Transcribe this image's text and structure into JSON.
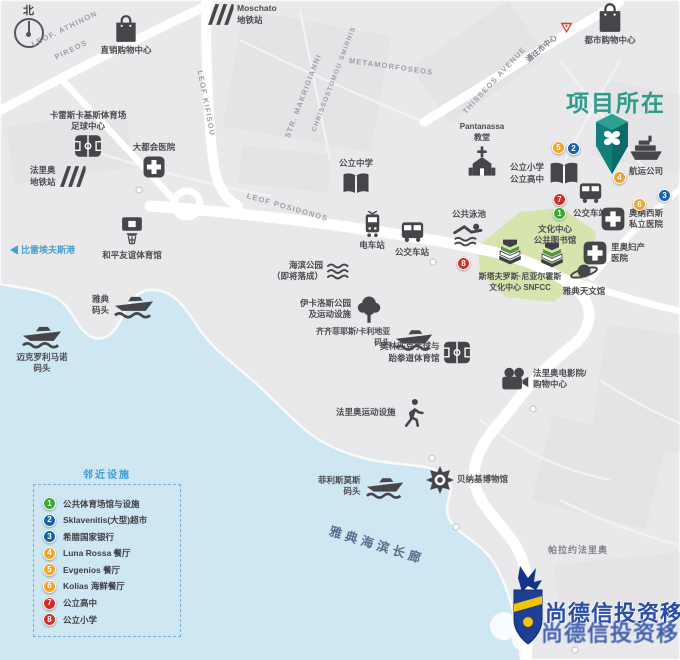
{
  "compass": {
    "north": "北"
  },
  "project": {
    "title": "项目所在"
  },
  "streets": {
    "athinon1": "LEOF. ATHINON",
    "athinon2": "PIREOS",
    "kifisou": "LEOF KIFISOU",
    "makrigianni": "STR. MAKRIGIANNI",
    "chrissostomou": "CHRISSOSTOMOU SMIRNIS",
    "metamorfoseos": "METAMORFOSEOS",
    "thisseos": "THISSEOS AVENUE",
    "posidonos": "LEOF POSIDONOS",
    "to_center": "通往市中心"
  },
  "pois": {
    "outlet_mall": {
      "l1": "直销购物中心"
    },
    "moschato": {
      "l1": "Moschato",
      "l2": "地铁站"
    },
    "faliro_metro": {
      "l1": "法里奥",
      "l2": "地铁站"
    },
    "karaiskakis": {
      "l1": "卡雷斯卡基斯体育场",
      "l2": "足球中心"
    },
    "metropolitan_hospital": {
      "l1": "大都会医院"
    },
    "middle_school": {
      "l1": "公立中学"
    },
    "tram_station": {
      "l1": "电车站"
    },
    "bus_station_center": {
      "l1": "公交车站"
    },
    "public_pool": {
      "l1": "公共泳池"
    },
    "seaside_park": {
      "l1": "海滨公园",
      "l2": "（即将落成）"
    },
    "ikaros_park": {
      "l1": "伊卡洛斯公园",
      "l2": "及运动设施"
    },
    "kallithea_marina": {
      "l1": "齐齐菲耶斯/卡利地亚",
      "l2": "码头"
    },
    "handball_arena": {
      "l1": "奥林匹克手球与",
      "l2": "跆拳道体育馆"
    },
    "faliro_cinema": {
      "l1": "法里奥电影院/",
      "l2": "购物中心"
    },
    "faliro_sports": {
      "l1": "法里奥运动设施"
    },
    "flisvos_marina": {
      "l1": "菲利斯莫斯",
      "l2": "码头"
    },
    "benaki_museum": {
      "l1": "贝纳基博物馆"
    },
    "palaio_faliro": {
      "l1": "帕拉约法里奥"
    },
    "promenade": {
      "l1": "雅典海滨长廊"
    },
    "peace_stadium": {
      "l1": "和平友谊体育馆"
    },
    "piraeus_port": {
      "l1": "比雷埃夫斯港"
    },
    "athens_marina": {
      "l1": "雅典",
      "l2": "码头"
    },
    "mikrolimano": {
      "l1": "迈克罗利马诺",
      "l2": "码头"
    },
    "pantanassa": {
      "l1": "Pantanassa",
      "l2": "教堂"
    },
    "primary_high_school": {
      "l1": "公立小学",
      "l2": "公立高中"
    },
    "bus_station_right": {
      "l1": "公交车站"
    },
    "culture_center": {
      "l1": "文化中心",
      "l2": "公共图书馆"
    },
    "snfcc": {
      "l1": "斯塔夫罗斯·尼亚尔霍斯",
      "l2": "文化中心 SNFCC"
    },
    "onassis_hospital": {
      "l1": "奥纳西斯",
      "l2": "私立医院"
    },
    "maternity_hospital": {
      "l1": "里奥妇产",
      "l2": "医院"
    },
    "planetarium": {
      "l1": "雅典天文馆"
    },
    "shipping_company": {
      "l1": "航运公司"
    },
    "city_mall": {
      "l1": "都市购物中心"
    }
  },
  "badges": {
    "n1": "1",
    "n2": "2",
    "n3": "3",
    "n4": "4",
    "n5": "5",
    "n6": "6",
    "n7": "7",
    "n8": "8"
  },
  "legend": {
    "title": "邻近设施",
    "items": [
      {
        "num": "1",
        "color": "#3aa838",
        "label": "公共体育场馆与设施"
      },
      {
        "num": "2",
        "color": "#1663ad",
        "label": "Sklavenitis(大型)超市"
      },
      {
        "num": "3",
        "color": "#1663ad",
        "label": "希腊国家银行"
      },
      {
        "num": "4",
        "color": "#f5a226",
        "label": "Luna Rossa 餐厅"
      },
      {
        "num": "5",
        "color": "#f5a226",
        "label": "Evgenios 餐厅"
      },
      {
        "num": "6",
        "color": "#f5a226",
        "label": "Kolias 海鲜餐厅"
      },
      {
        "num": "7",
        "color": "#d42f27",
        "label": "公立高中"
      },
      {
        "num": "8",
        "color": "#d42f27",
        "label": "公立小学"
      }
    ]
  },
  "watermark": {
    "line1": "尚德信投资移民",
    "line2": "尚德信投资移民"
  },
  "colors": {
    "sea": "#cfe7f3",
    "project_teal": "#2e9c8c",
    "legend_blue": "#3b9bd5",
    "promenade_blue": "#54708e",
    "watermark_blue": "#2a4da6",
    "badge_green": "#3aa838",
    "badge_blue": "#1663ad",
    "badge_orange": "#f5a226",
    "badge_red": "#d42f27"
  }
}
